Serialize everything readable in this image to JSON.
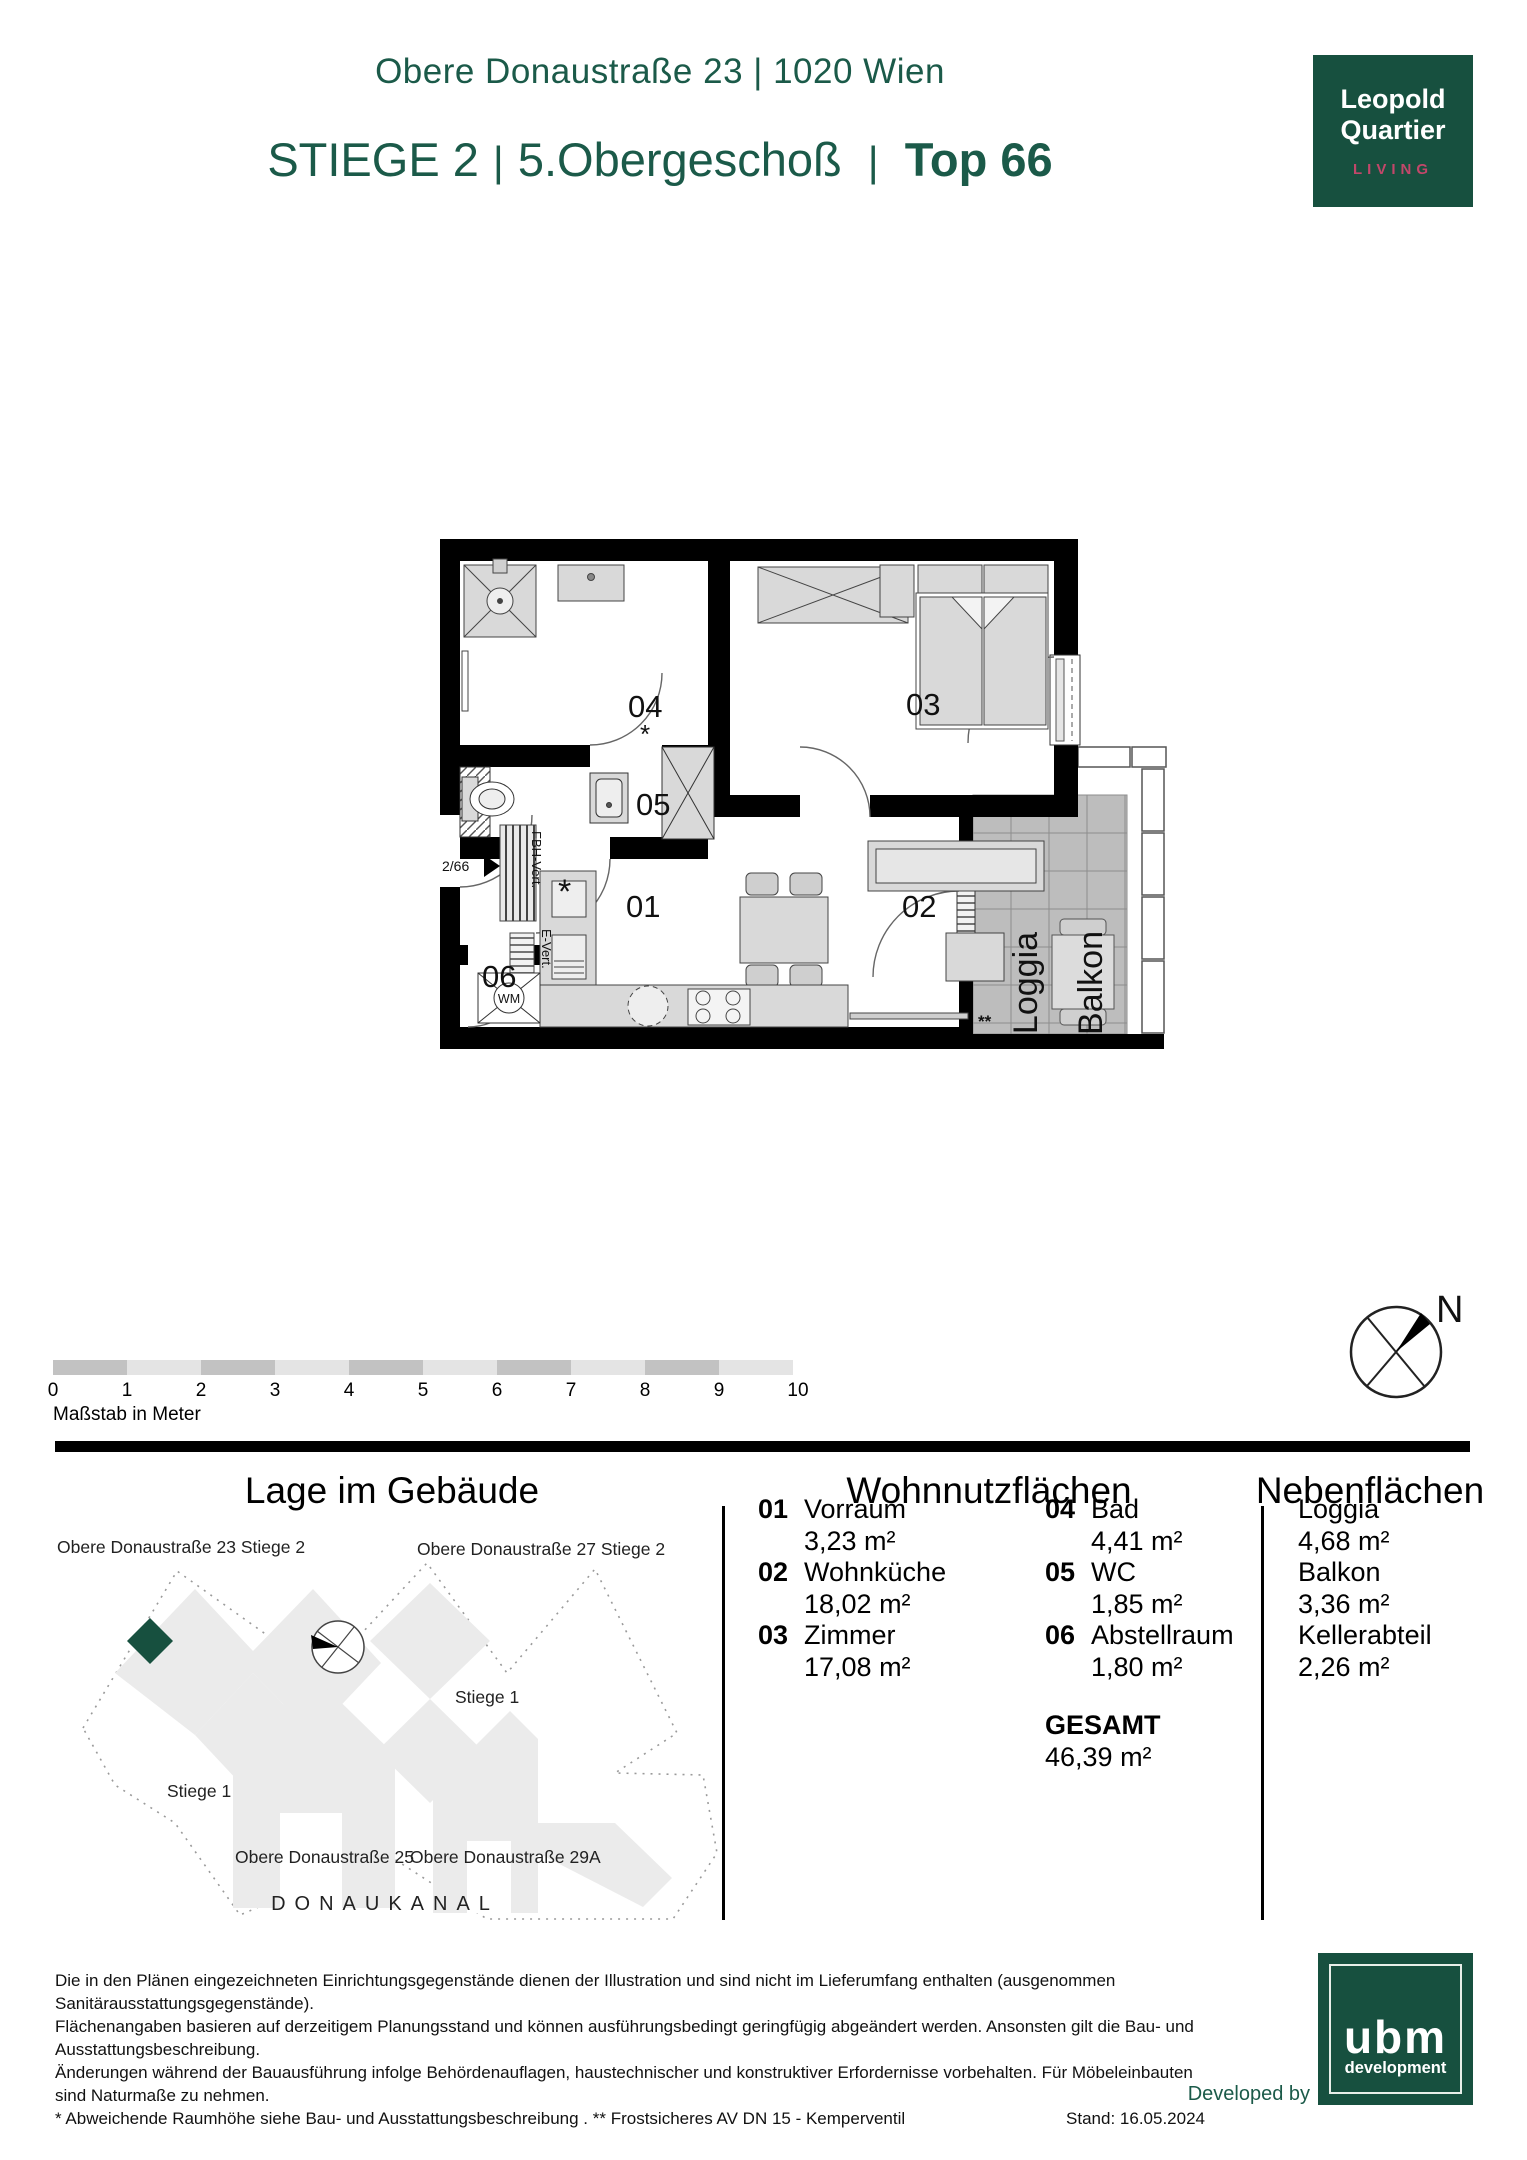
{
  "header": {
    "address_line": "Obere Donaustraße 23 | 1020 Wien",
    "stiege": "STIEGE 2",
    "floor": "5.Obergeschoß",
    "top": "Top 66",
    "sep": "|"
  },
  "logo": {
    "line1": "Leopold",
    "line2": "Quartier",
    "sub": "LIVING"
  },
  "plan": {
    "labels": {
      "r01": "01",
      "r02": "02",
      "r03": "03",
      "r04": "04",
      "r05": "05",
      "r06": "06",
      "asterisk": "*",
      "double_asterisk": "**",
      "loggia": "Loggia",
      "balkon": "Balkon",
      "wm": "WM",
      "entrance": "2/66",
      "fbh": "FBH-Vert.",
      "evert": "E-Vert."
    }
  },
  "scale_bar": {
    "ticks": [
      "0",
      "1",
      "2",
      "3",
      "4",
      "5",
      "6",
      "7",
      "8",
      "9",
      "10"
    ],
    "caption": "Maßstab in Meter"
  },
  "compass": {
    "north": "N"
  },
  "site": {
    "title": "Lage im Gebäude",
    "labels": {
      "b23": "Obere Donaustraße 23 Stiege 2",
      "b27": "Obere Donaustraße 27 Stiege 2",
      "stiege1_right": "Stiege 1",
      "stiege1_left": "Stiege 1",
      "b25": "Obere Donaustraße 25",
      "b29a": "Obere Donaustraße 29A",
      "canal": "DONAUKANAL"
    }
  },
  "areas": {
    "living_title": "Wohnnutzflächen",
    "secondary_title": "Nebenflächen",
    "rooms": [
      {
        "nr": "01",
        "name": "Vorraum",
        "area": "3,23 m²"
      },
      {
        "nr": "02",
        "name": "Wohnküche",
        "area": "18,02 m²"
      },
      {
        "nr": "03",
        "name": "Zimmer",
        "area": "17,08 m²"
      },
      {
        "nr": "04",
        "name": "Bad",
        "area": "4,41 m²"
      },
      {
        "nr": "05",
        "name": "WC",
        "area": "1,85 m²"
      },
      {
        "nr": "06",
        "name": "Abstellraum",
        "area": "1,80 m²"
      }
    ],
    "total_label": "GESAMT",
    "total_area": "46,39 m²",
    "secondary": [
      {
        "name": "Loggia",
        "area": "4,68 m²"
      },
      {
        "name": "Balkon",
        "area": "3,36 m²"
      },
      {
        "name": "Kellerabteil",
        "area": "2,26 m²"
      }
    ]
  },
  "footer": {
    "line1": "Die in den Plänen eingezeichneten Einrichtungsgegenstände dienen der Illustration und sind nicht im Lieferumfang enthalten (ausgenommen Sanitärausstattungsgegenstände).",
    "line2": "Flächenangaben basieren auf derzeitigem Planungsstand und können ausführungsbedingt geringfügig abgeändert werden. Ansonsten gilt die Bau- und Ausstattungsbeschreibung.",
    "line3": "Änderungen während der Bauausführung infolge Behördenauflagen, haustechnischer und konstruktiver Erfordernisse vorbehalten. Für Möbeleinbauten sind Naturmaße zu nehmen.",
    "line4": "* Abweichende Raumhöhe siehe Bau- und Ausstattungsbeschreibung . ** Frostsicheres AV DN 15 - Kemperventil",
    "stand": "Stand: 16.05.2024",
    "developed_by": "Developed by"
  },
  "ubm": {
    "name": "ubm",
    "sub": "development"
  },
  "colors": {
    "green": "#1b5a49",
    "logo_green": "#17503f",
    "pink": "#c2476a"
  }
}
